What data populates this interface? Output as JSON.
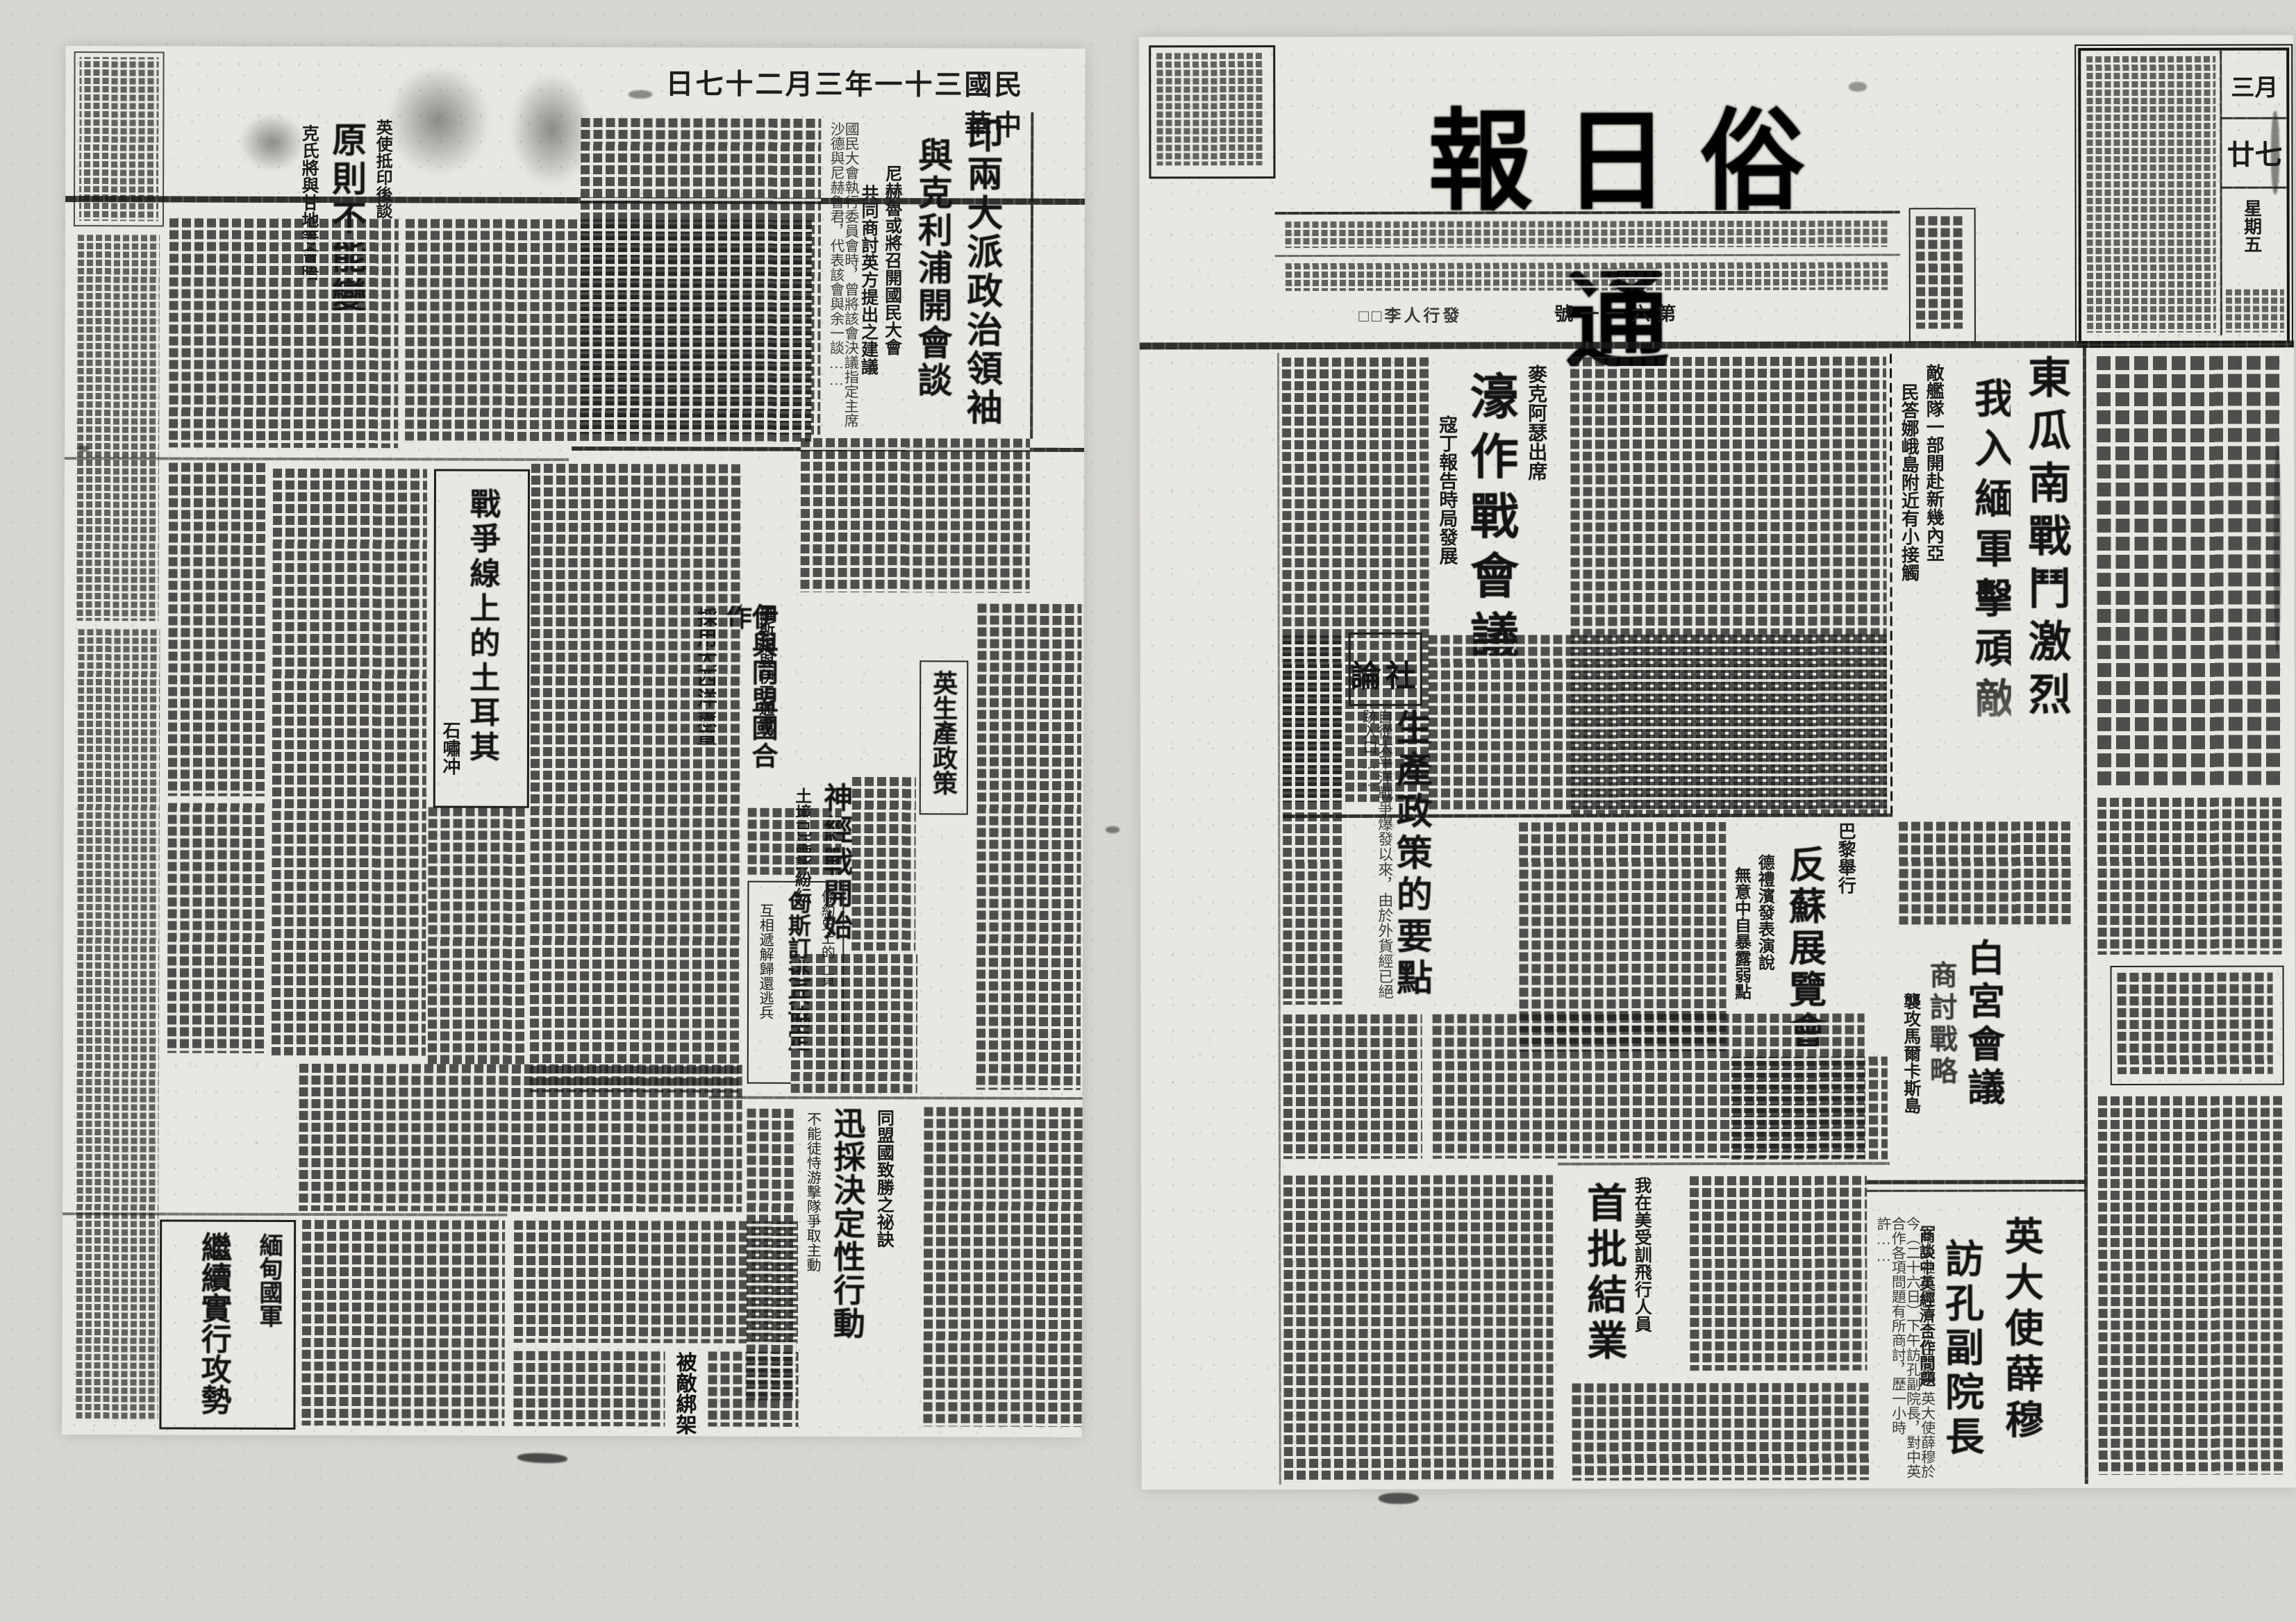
{
  "scan": {
    "date": "中華民國三十一年三月二十七日",
    "date_display": "日七十二月三年一十三國民華中"
  },
  "right_page": {
    "masthead": {
      "title": "通俗日報",
      "title_display": "報日俗通",
      "issue_display": "號一一六第",
      "publisher_display": "□□李人行發",
      "calendar": {
        "month": "三月",
        "day": "廿七",
        "weekday": "星期五"
      }
    },
    "stories": {
      "burma_battle": {
        "headline": [
          "東瓜南戰鬥激烈",
          "我入緬軍擊頑敵"
        ],
        "subheads": [
          "敵艦隊一部開赴新幾內亞",
          "民答娜峨島附近有小接觸"
        ]
      },
      "australia_council": {
        "kicker": "麥克阿瑟出席",
        "headline": "濠作戰會議",
        "subhead": "寇丁報告時局發展"
      },
      "editorial": {
        "label": "社論",
        "label_display": "論社",
        "title": "生產政策的要點",
        "lede": "自從太平洋戰爭爆發以來，由於外貨經已絕跡入口……"
      },
      "paris_expo": {
        "kicker": "巴黎舉行",
        "headline": "反蘇展覽會",
        "subheads": [
          "德禮濱發表演說",
          "無意中自暴露弱點"
        ]
      },
      "white_house": {
        "kicker": "襲攻馬爾卡斯島",
        "headline": [
          "白宮會議",
          "商討戰略"
        ]
      },
      "uk_ambassador": {
        "headline": [
          "英大使薛穆",
          "訪孔副院長"
        ],
        "subhead": "商談中英經濟合作問題",
        "lede": "【中央社重慶二十六日電】英大使薛穆於今（二十六日）下午訪孔副院長，對中英合作各項問題有所商討，歷一小時許……"
      },
      "pilots": {
        "kicker": "我在美受訓飛行人員",
        "headline": "首批結業"
      }
    }
  },
  "left_page": {
    "stories": {
      "cripps_talks": {
        "headline": [
          "印兩大派政治領袖",
          "與克利浦開會談"
        ],
        "subheads": [
          "尼赫魯或將召開國民大會",
          "共同商討英方提出之建議"
        ],
        "lede": "國民大會執行委員會時，曾將該會決議指定主席沙德與尼赫魯君，代表該會與余一談……"
      },
      "principle": {
        "kicker": "英使抵印後談",
        "headline": "原則不能變",
        "subhead": "克氏將與甘地等會晤"
      },
      "turkey_feature": {
        "title": "戰爭線上的土耳其",
        "author": "石嘯冲"
      },
      "iran": {
        "kicker": "羅斯福與伊王通電",
        "headline": "伊與同盟國合作",
        "subhead": "採用大西洋憲章"
      },
      "uk_production": {
        "title": "英生產政策"
      },
      "nerve_war": {
        "headline": "神經戰開始",
        "subhead": "土境已謠諑紛紜"
      },
      "deserters_pact": {
        "kicker": "條約史上的一頁",
        "headline": "匈斯訂逃兵協定",
        "subhead": "互相遞解歸還逃兵"
      },
      "allied_secret": {
        "kicker": "同盟國致勝之祕訣",
        "headline": "迅採決定性行動",
        "subhead": "不能徒恃游擊隊爭取主動"
      },
      "burma_offensive": {
        "headline": [
          "緬甸國軍",
          "繼續實行攻勢"
        ]
      },
      "kidnapped": {
        "headline": "被敵綁架"
      }
    }
  }
}
